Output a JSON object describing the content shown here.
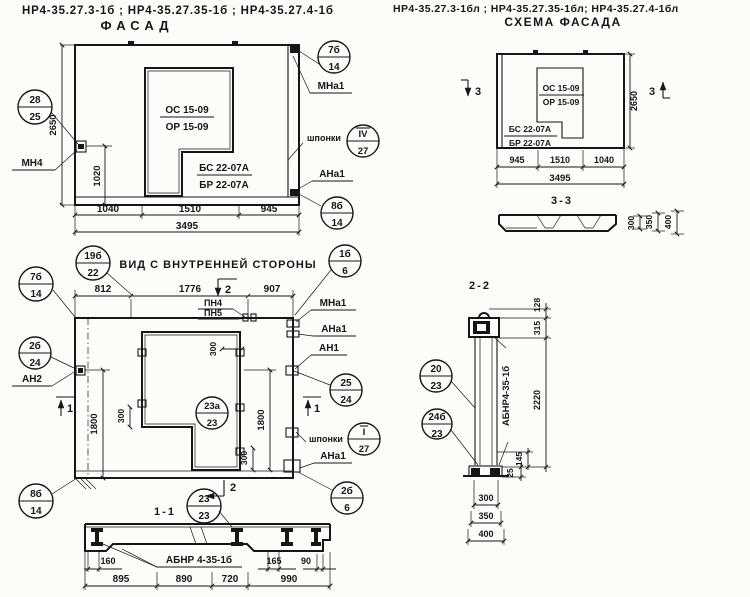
{
  "header": {
    "left_codes": "НР4-35.27.3-1б ; НР4-35.27.35-1б ; НР4-35.27.4-1б",
    "right_codes": "НР4-35.27.3-1бл ; НР4-35.27.35-1бл; НР4-35.27.4-1бл"
  },
  "fasad": {
    "title": "ФАСАД",
    "window_mark_top": "ОС 15-09",
    "window_mark_bottom": "ОР 15-09",
    "panel_mark_top": "БС 22-07А",
    "panel_mark_bottom": "БР 22-07А",
    "dim_height": "2650",
    "dim_anchor": "1020",
    "dim_b1": "1040",
    "dim_b2": "1510",
    "dim_b3": "945",
    "dim_total": "3495",
    "callout_28_top": "28",
    "callout_28_bottom": "25",
    "label_mn4": "МН4",
    "callout_7_top": "7б",
    "callout_7_bottom": "14",
    "label_mna1": "МНа1",
    "label_shponki": "шпонки",
    "callout_iv_top": "IV",
    "callout_iv_bottom": "27",
    "label_ana1": "АНа1",
    "callout_8_top": "8б",
    "callout_8_bottom": "14"
  },
  "inner": {
    "title": "ВИД С ВНУТРЕННЕЙ СТОРОНЫ",
    "callout_19_top": "19б",
    "callout_19_bottom": "22",
    "dim_t1": "812",
    "dim_t2": "1776",
    "dim_t3": "907",
    "sec_mark_2": "2",
    "sec_mark_1": "1",
    "label_pn4": "ПН4",
    "label_pn5": "ПН5",
    "callout_1b_top": "1б",
    "callout_1b_bottom": "6",
    "label_mna1": "МНа1",
    "label_ana1": "АНа1",
    "label_an1": "АН1",
    "label_an2": "АН2",
    "label_shponki": "шпонки",
    "callout_7_top": "7б",
    "callout_7_bottom": "14",
    "callout_2b_top": "2б",
    "callout_2b_bottom": "24",
    "callout_25_top": "25",
    "callout_25_bottom": "24",
    "callout_i_top": "I",
    "callout_i_bottom": "27",
    "callout_23a_top": "23а",
    "callout_23a_bottom": "23",
    "callout_8_top": "8б",
    "callout_8_bottom": "14",
    "callout_2b6_top": "2б",
    "callout_2b6_bottom": "6",
    "dim_1800": "1800",
    "dim_300": "300"
  },
  "sec11": {
    "title": "1-1",
    "callout_23_top": "23",
    "callout_23_bottom": "23",
    "label_mark": "АБНР 4-35-1б",
    "d160": "160",
    "d165": "165",
    "d90": "90",
    "d895": "895",
    "d890": "890",
    "d720": "720",
    "d990": "990"
  },
  "schema": {
    "title": "СХЕМА ФАСАДА",
    "window_mark_top": "ОС 15-09",
    "window_mark_bottom": "ОР 15-09",
    "panel_mark_top": "БС 22-07А",
    "panel_mark_bottom": "БР 22-07А",
    "sec_mark_3": "3",
    "dim_height": "2650",
    "dim_b1": "945",
    "dim_b2": "1510",
    "dim_b3": "1040",
    "dim_total": "3495"
  },
  "sec33": {
    "title": "3-3",
    "d300": "300",
    "d350": "350",
    "d400": "400"
  },
  "sec22": {
    "title": "2-2",
    "label_mark": "АБНР4-35-1б",
    "d128": "128",
    "d315": "315",
    "d2220": "2220",
    "d145": "145",
    "d25": "25",
    "d300": "300",
    "d350": "350",
    "d400": "400",
    "callout_20_top": "20",
    "callout_20_bottom": "23",
    "callout_24_top": "24б",
    "callout_24_bottom": "23"
  }
}
